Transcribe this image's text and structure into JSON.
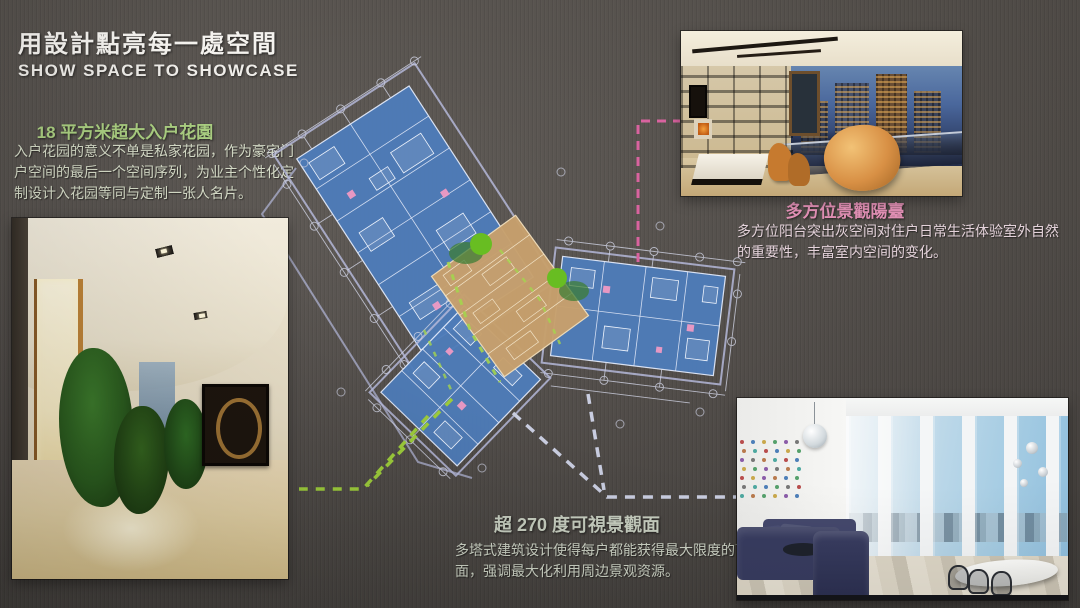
{
  "slide": {
    "title": "用設計點亮每一處空間",
    "subtitle": "SHOW SPACE TO SHOWCASE"
  },
  "callouts": {
    "garden": {
      "heading": "18 平方米超大入户花園",
      "body": "入户花园的意义不单是私家花园，作为豪宅门户空间的最后一个空间序列，为业主个性化定制设计入花园等同与定制一张人名片。",
      "accent_color": "#a9cd80"
    },
    "balcony": {
      "heading": "多方位景觀陽臺",
      "body": "多方位阳台突出灰空间对住户日常生活体验室外自然的重要性，丰富室内空间的变化。",
      "accent_color": "#e08fb4"
    },
    "view": {
      "heading": "超 270 度可視景觀面",
      "body": "多塔式建筑设计使得每户都能获得最大限度的可视景观面，强调最大化利用周边景观资源。",
      "accent_color": "#c6cdbf"
    }
  },
  "floor_plan": {
    "colors": {
      "unit_fill": "#4e7cb9",
      "core_fill": "#c7a06d",
      "tree_green": "#68bd22",
      "site_outline": "#b4b7d8",
      "cad_linework": "#e3e9f8",
      "leader_to_balcony": "#d9639f",
      "leader_to_garden": "#9ccb3b",
      "leader_to_view": "#c9cde0"
    }
  }
}
